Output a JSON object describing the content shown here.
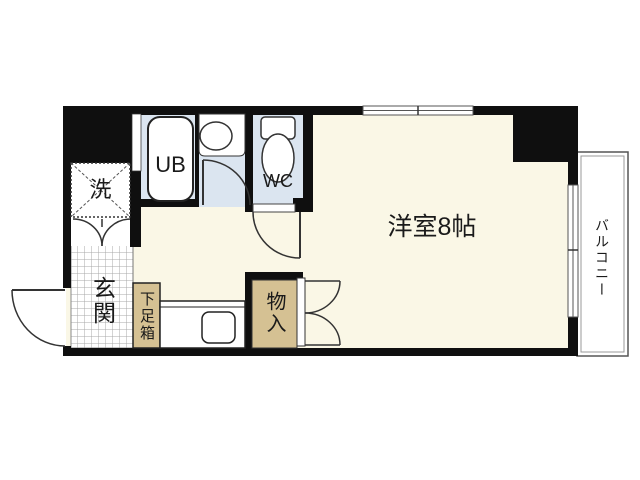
{
  "floorplan": {
    "title": "apartment-floor-plan",
    "rooms": {
      "main_room": {
        "label": "洋室8帖"
      },
      "entrance": {
        "label": "玄関"
      },
      "balcony": {
        "label": "バルコニー"
      },
      "unit_bath": {
        "label": "UB"
      },
      "toilet": {
        "label": "WC"
      },
      "laundry": {
        "label": "洗"
      },
      "shoe_box": {
        "label": "下足箱"
      },
      "storage": {
        "label": "物入"
      }
    },
    "colors": {
      "wall": "#0f0f0f",
      "room_fill": "#faf7e6",
      "wet_area_fill": "#dbe5f0",
      "storage_fill": "#d5c193",
      "background": "#ffffff",
      "tile_line": "#a8a8a8"
    }
  }
}
